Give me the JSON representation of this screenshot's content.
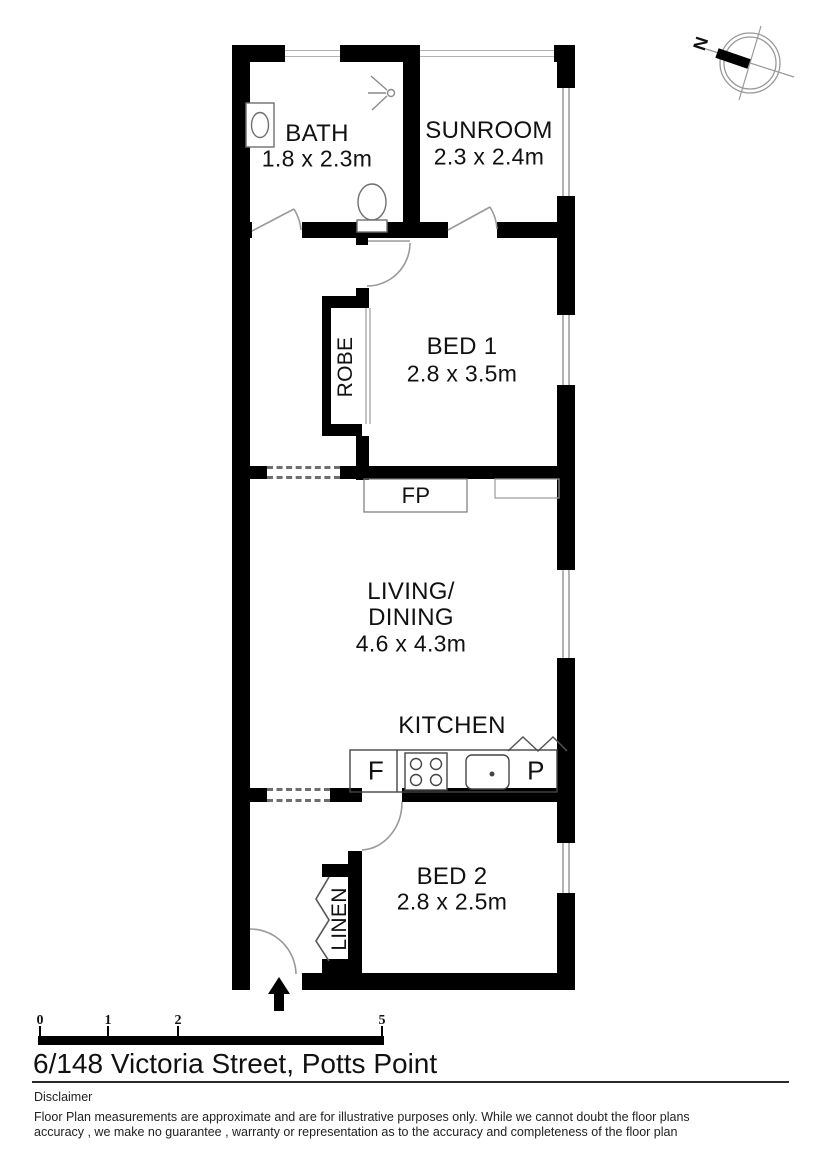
{
  "address": "6/148 Victoria Street, Potts Point",
  "compass": {
    "north_label": "N"
  },
  "rooms": {
    "bath": {
      "label": "BATH",
      "dims": "1.8 x 2.3m"
    },
    "sunroom": {
      "label": "SUNROOM",
      "dims": "2.3 x 2.4m"
    },
    "bed1": {
      "label": "BED 1",
      "dims": "2.8 x 3.5m"
    },
    "living": {
      "label_line1": "LIVING/",
      "label_line2": "DINING",
      "dims": "4.6 x 4.3m"
    },
    "kitchen": {
      "label": "KITCHEN"
    },
    "bed2": {
      "label": "BED 2",
      "dims": "2.8 x 2.5m"
    }
  },
  "closets": {
    "robe_label": "ROBE",
    "linen_label": "LINEN"
  },
  "fixtures": {
    "fireplace_label": "FP",
    "fridge_label": "F",
    "pantry_label": "P"
  },
  "scale_bar": {
    "tick_labels": [
      "0",
      "1",
      "2",
      "5"
    ]
  },
  "disclaimer": {
    "heading": "Disclaimer",
    "line1": "Floor Plan measurements are approximate and are for illustrative purposes only. While we cannot doubt the floor plans",
    "line2": "accuracy , we make no guarantee , warranty or representation as to the accuracy and completeness of the floor plan"
  },
  "colors": {
    "wall": "#000000",
    "door_line": "#9a9a9a",
    "fixture_line": "#555555",
    "background": "#ffffff",
    "text": "#111111"
  }
}
